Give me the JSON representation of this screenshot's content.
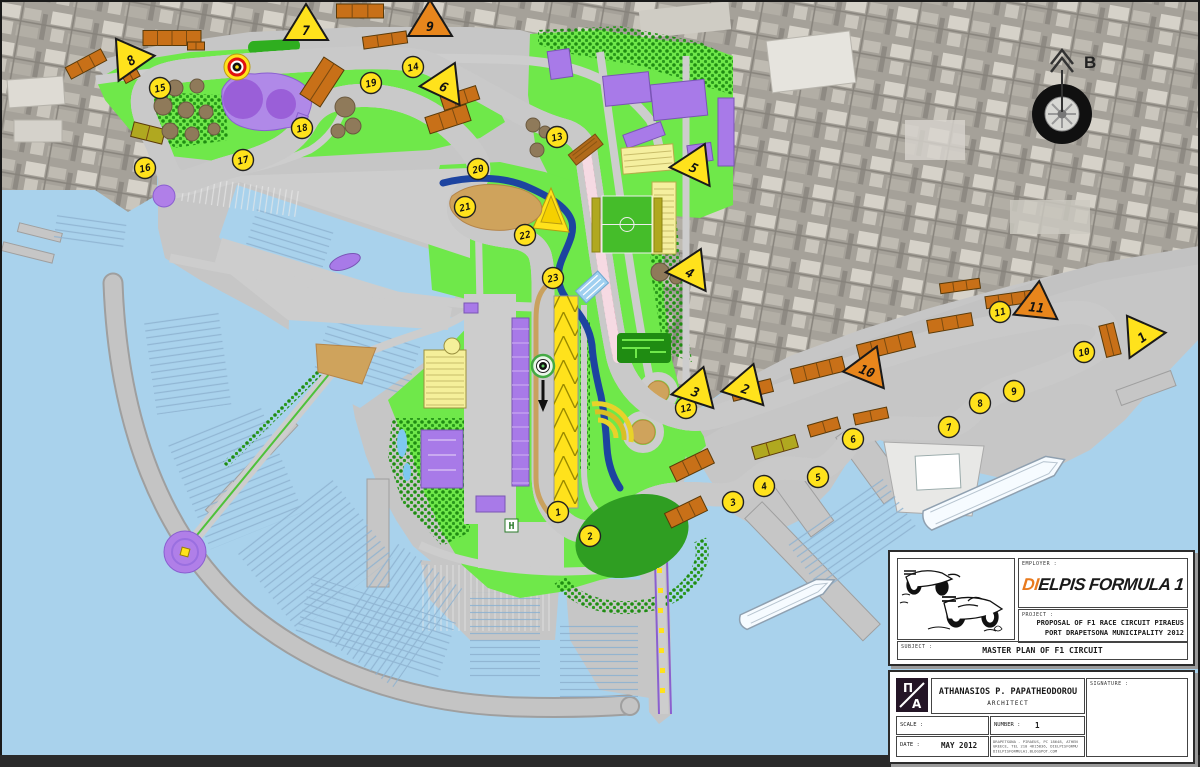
{
  "drawing": {
    "north_label": "B",
    "helipad_label": "H",
    "turn_markers": [
      {
        "n": "1",
        "x": 558,
        "y": 512
      },
      {
        "n": "2",
        "x": 590,
        "y": 536
      },
      {
        "n": "3",
        "x": 733,
        "y": 502
      },
      {
        "n": "4",
        "x": 764,
        "y": 486
      },
      {
        "n": "5",
        "x": 818,
        "y": 477
      },
      {
        "n": "6",
        "x": 853,
        "y": 439
      },
      {
        "n": "7",
        "x": 949,
        "y": 427
      },
      {
        "n": "8",
        "x": 980,
        "y": 403
      },
      {
        "n": "9",
        "x": 1014,
        "y": 391
      },
      {
        "n": "10",
        "x": 1084,
        "y": 352
      },
      {
        "n": "11",
        "x": 1000,
        "y": 312
      },
      {
        "n": "12",
        "x": 686,
        "y": 408
      },
      {
        "n": "13",
        "x": 557,
        "y": 137
      },
      {
        "n": "14",
        "x": 413,
        "y": 67
      },
      {
        "n": "15",
        "x": 160,
        "y": 88
      },
      {
        "n": "16",
        "x": 145,
        "y": 168
      },
      {
        "n": "17",
        "x": 243,
        "y": 160
      },
      {
        "n": "18",
        "x": 302,
        "y": 128
      },
      {
        "n": "19",
        "x": 371,
        "y": 83
      },
      {
        "n": "20",
        "x": 478,
        "y": 169
      },
      {
        "n": "21",
        "x": 465,
        "y": 207
      },
      {
        "n": "22",
        "x": 525,
        "y": 235
      },
      {
        "n": "23",
        "x": 553,
        "y": 278
      }
    ],
    "posts_yellow": [
      {
        "n": "1",
        "x": 1139,
        "y": 333,
        "rot": -35
      },
      {
        "n": "2",
        "x": 747,
        "y": 384,
        "rot": 18
      },
      {
        "n": "3",
        "x": 697,
        "y": 387,
        "rot": 18
      },
      {
        "n": "4",
        "x": 692,
        "y": 268,
        "rot": 25
      },
      {
        "n": "5",
        "x": 696,
        "y": 163,
        "rot": 25
      },
      {
        "n": "6",
        "x": 446,
        "y": 82,
        "rot": 25
      },
      {
        "n": "7",
        "x": 306,
        "y": 25,
        "rot": 0
      },
      {
        "n": "8",
        "x": 128,
        "y": 56,
        "rot": -35
      }
    ],
    "posts_orange": [
      {
        "n": "9",
        "x": 430,
        "y": 21,
        "rot": 0
      },
      {
        "n": "10",
        "x": 869,
        "y": 366,
        "rot": 22
      },
      {
        "n": "11",
        "x": 1037,
        "y": 302,
        "rot": 6
      }
    ],
    "grandstands": [
      {
        "x": 172,
        "y": 38,
        "w": 58,
        "h": 15,
        "r": 0,
        "c": "o"
      },
      {
        "x": 86,
        "y": 64,
        "w": 40,
        "h": 13,
        "r": -28,
        "c": "o"
      },
      {
        "x": 130,
        "y": 74,
        "w": 16,
        "h": 13,
        "r": -28,
        "c": "o"
      },
      {
        "x": 360,
        "y": 11,
        "w": 47,
        "h": 14,
        "r": 0,
        "c": "o"
      },
      {
        "x": 385,
        "y": 40,
        "w": 44,
        "h": 12,
        "r": -8,
        "c": "o"
      },
      {
        "x": 196,
        "y": 46,
        "w": 17,
        "h": 8,
        "r": 0,
        "c": "o"
      },
      {
        "x": 322,
        "y": 82,
        "w": 24,
        "h": 44,
        "r": 33,
        "c": "o"
      },
      {
        "x": 460,
        "y": 98,
        "w": 37,
        "h": 14,
        "r": -18,
        "c": "o"
      },
      {
        "x": 448,
        "y": 119,
        "w": 43,
        "h": 17,
        "r": -18,
        "c": "o"
      },
      {
        "x": 148,
        "y": 133,
        "w": 32,
        "h": 15,
        "r": 14,
        "c": "v"
      },
      {
        "x": 692,
        "y": 465,
        "w": 42,
        "h": 16,
        "r": -26,
        "c": "o"
      },
      {
        "x": 686,
        "y": 512,
        "w": 40,
        "h": 16,
        "r": -26,
        "c": "o"
      },
      {
        "x": 775,
        "y": 447,
        "w": 45,
        "h": 13,
        "r": -16,
        "c": "v"
      },
      {
        "x": 824,
        "y": 427,
        "w": 31,
        "h": 12,
        "r": -16,
        "c": "o"
      },
      {
        "x": 871,
        "y": 416,
        "w": 34,
        "h": 11,
        "r": -12,
        "c": "o"
      },
      {
        "x": 752,
        "y": 390,
        "w": 41,
        "h": 13,
        "r": -14,
        "c": "o"
      },
      {
        "x": 818,
        "y": 370,
        "w": 53,
        "h": 15,
        "r": -14,
        "c": "o"
      },
      {
        "x": 886,
        "y": 346,
        "w": 57,
        "h": 16,
        "r": -14,
        "c": "o"
      },
      {
        "x": 950,
        "y": 323,
        "w": 45,
        "h": 13,
        "r": -10,
        "c": "o"
      },
      {
        "x": 1012,
        "y": 299,
        "w": 53,
        "h": 12,
        "r": -8,
        "c": "o"
      },
      {
        "x": 960,
        "y": 286,
        "w": 40,
        "h": 10,
        "r": -8,
        "c": "o"
      },
      {
        "x": 1110,
        "y": 340,
        "w": 15,
        "h": 32,
        "r": -14,
        "c": "o"
      }
    ],
    "tanks": [
      {
        "x": 175,
        "y": 88,
        "r": 8
      },
      {
        "x": 197,
        "y": 86,
        "r": 7
      },
      {
        "x": 163,
        "y": 106,
        "r": 9
      },
      {
        "x": 186,
        "y": 110,
        "r": 8
      },
      {
        "x": 206,
        "y": 112,
        "r": 7
      },
      {
        "x": 170,
        "y": 131,
        "r": 8
      },
      {
        "x": 192,
        "y": 134,
        "r": 7
      },
      {
        "x": 214,
        "y": 129,
        "r": 6
      },
      {
        "x": 345,
        "y": 107,
        "r": 10
      },
      {
        "x": 353,
        "y": 126,
        "r": 8
      },
      {
        "x": 338,
        "y": 131,
        "r": 7
      },
      {
        "x": 533,
        "y": 125,
        "r": 7
      },
      {
        "x": 545,
        "y": 132,
        "r": 6
      },
      {
        "x": 537,
        "y": 150,
        "r": 7
      },
      {
        "x": 660,
        "y": 272,
        "r": 9
      },
      {
        "x": 676,
        "y": 278,
        "r": 6
      }
    ],
    "ships": [
      {
        "cx": 996,
        "cy": 490,
        "len": 150,
        "w": 21,
        "rot": -24
      },
      {
        "cx": 789,
        "cy": 601,
        "len": 100,
        "w": 16,
        "rot": -25
      }
    ]
  },
  "title_block": {
    "employer_label": "EMPLOYER :",
    "employer_di": "DI",
    "employer_rest": "ELPIS",
    "employer_formula": "FORMULA",
    "employer_one": "1",
    "project_label": "PROJECT :",
    "project_line1": "PROPOSAL OF F1 RACE CIRCUIT PIRAEUS",
    "project_line2": "PORT DRAPETSONA MUNICIPALITY 2012",
    "subject_label": "SUBJECT :",
    "subject_value": "MASTER PLAN OF F1 CIRCUIT",
    "architect_name": "ATHANASIOS P. PAPATHEODOROU",
    "architect_title": "ARCHITECT",
    "signature_label": "SIGNATURE :",
    "scale_label": "SCALE :",
    "scale_value": "",
    "number_label": "NUMBER :",
    "number_value": "1",
    "date_label": "DATE :",
    "date_value": "MAY 2012",
    "contact_line1": "DRAPETSONA - PIRAEUS, PC 18648, ATHENS",
    "contact_line2": "GREECE, TEL 210 4615836, DIELPISFORMULA1@GMAIL.COM",
    "contact_line3": "DIELPISFORMULA1.BLOGSPOT.COM",
    "logo_top": "Π",
    "logo_bottom": "A"
  }
}
